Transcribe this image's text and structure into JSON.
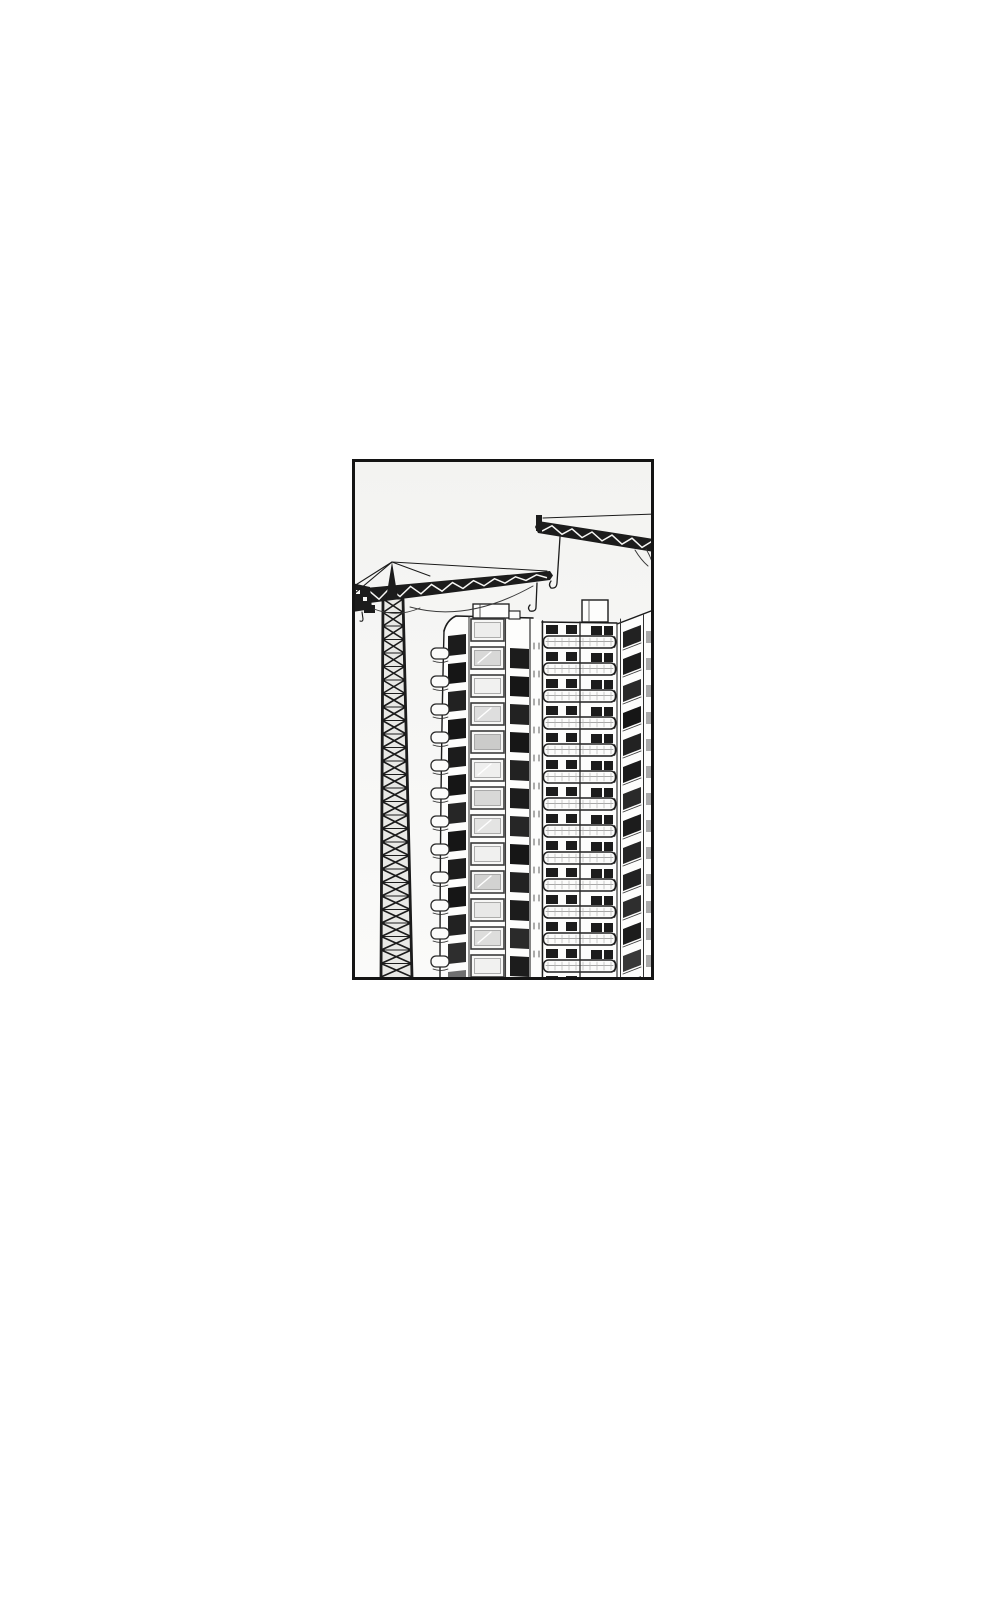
{
  "meta": {
    "description": "Black-and-white manga-style line-art panel: two tower construction cranes loom over two high-rise apartment towers under construction, framed by a rectangular black border centered on a white page."
  },
  "panel": {
    "x": 352,
    "y": 459,
    "width": 302,
    "height": 521,
    "border_width": 3,
    "border_color": "#141414",
    "sky_top": "#f3f3f1",
    "sky_bottom": "#fafaf9"
  },
  "palette": {
    "ink": "#1a1a1a",
    "ink_soft": "#343434",
    "wall": "#fdfdfc",
    "slab": "#fcfcfb",
    "window_dark": "#1b1b1b",
    "mast_fill": "#e9e9e6",
    "white_line": "#f7f7f5",
    "gray_dash": "#9a9a9a"
  },
  "crane_left": {
    "apex": [
      40,
      103
    ],
    "jib": {
      "x0": 2,
      "x1": 198,
      "top0": 130,
      "top1": 112,
      "bot0": 146,
      "bot1": 121
    },
    "mast": {
      "top_y": 140,
      "bottom_y": 518,
      "top_l": 31,
      "top_r": 51,
      "bot_l": 29,
      "bot_r": 60
    },
    "hook": {
      "x": 185,
      "y_top": 124,
      "y_bottom": 152
    }
  },
  "crane_right": {
    "jib": {
      "x0": 186,
      "x1": 302,
      "top0": 62,
      "top1": 80,
      "bot0": 74,
      "bot1": 93
    },
    "tie": [
      [
        191,
        59
      ],
      [
        302,
        55
      ]
    ],
    "hook": {
      "x": 208,
      "y_top": 78,
      "y_bottom": 129
    }
  },
  "building_left": {
    "floors": 13,
    "pitch": 28,
    "first_y": 158,
    "glass_shades": [
      "#ededec",
      "#d8d8d7",
      "#f1f1f0",
      "#dedede",
      "#cbcbca",
      "#efefee",
      "#d8d8d7",
      "#e4e4e3",
      "#f0f0ef",
      "#d2d2d1",
      "#e8e8e7",
      "#dddddc",
      "#f1f1f0"
    ],
    "col1_shades": [
      "#1b1b1b",
      "#161616",
      "#222222",
      "#191919",
      "#1e1e1e",
      "#141414",
      "#262626",
      "#191919",
      "#1c1c1c",
      "#171717",
      "#202020",
      "#2e2e2e",
      "#6f6f6f"
    ],
    "col3_shades": [
      "#1d1d1d",
      "#191919",
      "#242424",
      "#171717",
      "#202020",
      "#1b1b1b",
      "#282828",
      "#161616",
      "#222222",
      "#1a1a1a",
      "#2b2b2b",
      "#1e1e1e",
      "#3a3a3a"
    ]
  },
  "building_right": {
    "floors": 14,
    "pitch": 27,
    "first_y": 164,
    "slant_shades": [
      "#232323",
      "#1c1c1c",
      "#2a2a2a",
      "#191919",
      "#242424",
      "#1e1e1e",
      "#2c2c2c",
      "#1a1a1a",
      "#262626",
      "#202020",
      "#2e2e2e",
      "#1d1d1d",
      "#383838",
      "#4a4a4a"
    ]
  }
}
